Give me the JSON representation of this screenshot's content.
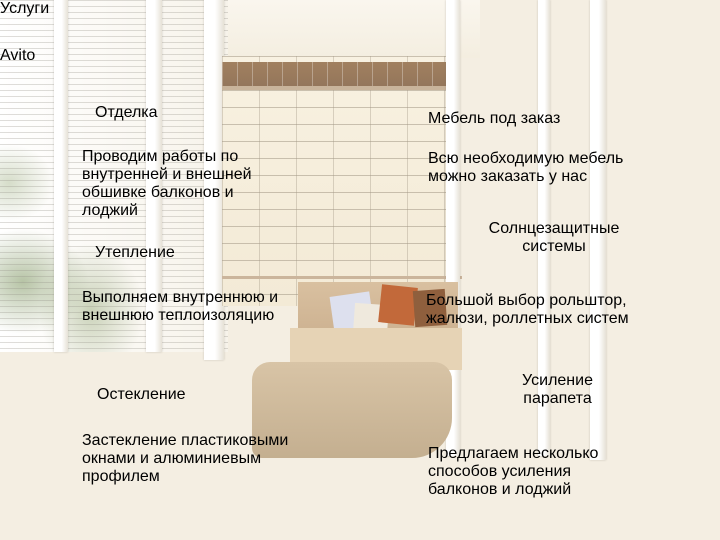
{
  "title": "Услуги",
  "colors": {
    "accent": "#F3A51D",
    "heading": "#241b11",
    "body": "#2e2b27",
    "title": "#0e0d0b"
  },
  "services": {
    "left": [
      {
        "heading_lines": [
          "Отделка"
        ],
        "lines": [
          "Проводим работы по",
          "внутренней и внешней",
          "обшивке балконов и",
          "лоджий"
        ]
      },
      {
        "heading_lines": [
          "Утепление"
        ],
        "lines": [
          "Выполняем внутреннюю и",
          "внешнюю теплоизоляцию"
        ]
      },
      {
        "heading_lines": [
          "Остекление"
        ],
        "lines": [
          "Застекление пластиковыми",
          "окнами и алюминиевым",
          "профилем"
        ]
      }
    ],
    "right": [
      {
        "heading_lines": [
          "Мебель под заказ"
        ],
        "lines": [
          "Всю необходимую мебель",
          "можно заказать у нас"
        ]
      },
      {
        "heading_lines": [
          "Солнцезащитные",
          "системы"
        ],
        "lines": [
          "Большой выбор рольштор,",
          "жалюзи, роллетных систем"
        ]
      },
      {
        "heading_lines": [
          "Усиление",
          "парапета"
        ],
        "lines": [
          "Предлагаем несколько",
          "способов усиления",
          "балконов и лоджий"
        ]
      }
    ]
  },
  "watermark": {
    "brand": "Avito"
  }
}
